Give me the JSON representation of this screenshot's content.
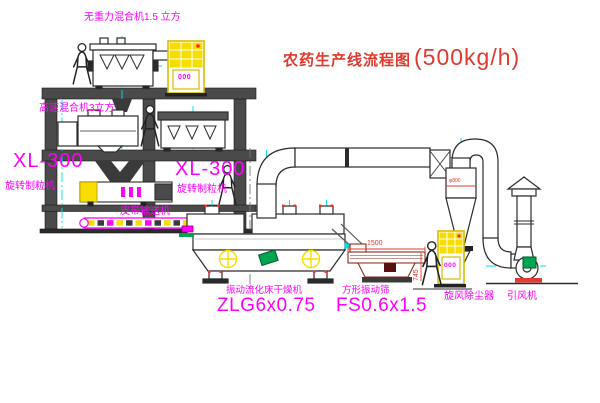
{
  "title": {
    "text_zh": "农药生产线流程图",
    "capacity": "(500kg/h)"
  },
  "equipment_labels": {
    "gravity_mixer": "无重力混合机1.5 立方",
    "high_speed_mixer": "高速混合机3立方",
    "granulator_left": {
      "model": "XL-300",
      "name": "旋转制粒机"
    },
    "granulator_mid": {
      "model": "XL-300",
      "name": "旋转制粒机"
    },
    "belt_conveyor": "皮带输送机",
    "dryer": {
      "name": "振动流化床干燥机",
      "model": "ZLG6x0.75"
    },
    "sieve": {
      "name": "方形振动筛",
      "model": "FS0.6x1.5"
    },
    "cyclone": "旋风除尘器",
    "fan": "引风机"
  },
  "dimensions": {
    "sieve_length": "1500",
    "sieve_height": "745",
    "cyclone_diameter": "φ800"
  },
  "panels": {
    "panel1_text": "000",
    "panel2_text": "000"
  },
  "colors": {
    "label_magenta": "#FF00FF",
    "title_red": "#E0392E",
    "centerline_cyan": "#00E0E0",
    "cabinet_yellow": "#F7DE00",
    "motor_green": "#00A550",
    "dimension_red": "#E53935",
    "drawing_dark": "#2B2B2B"
  }
}
